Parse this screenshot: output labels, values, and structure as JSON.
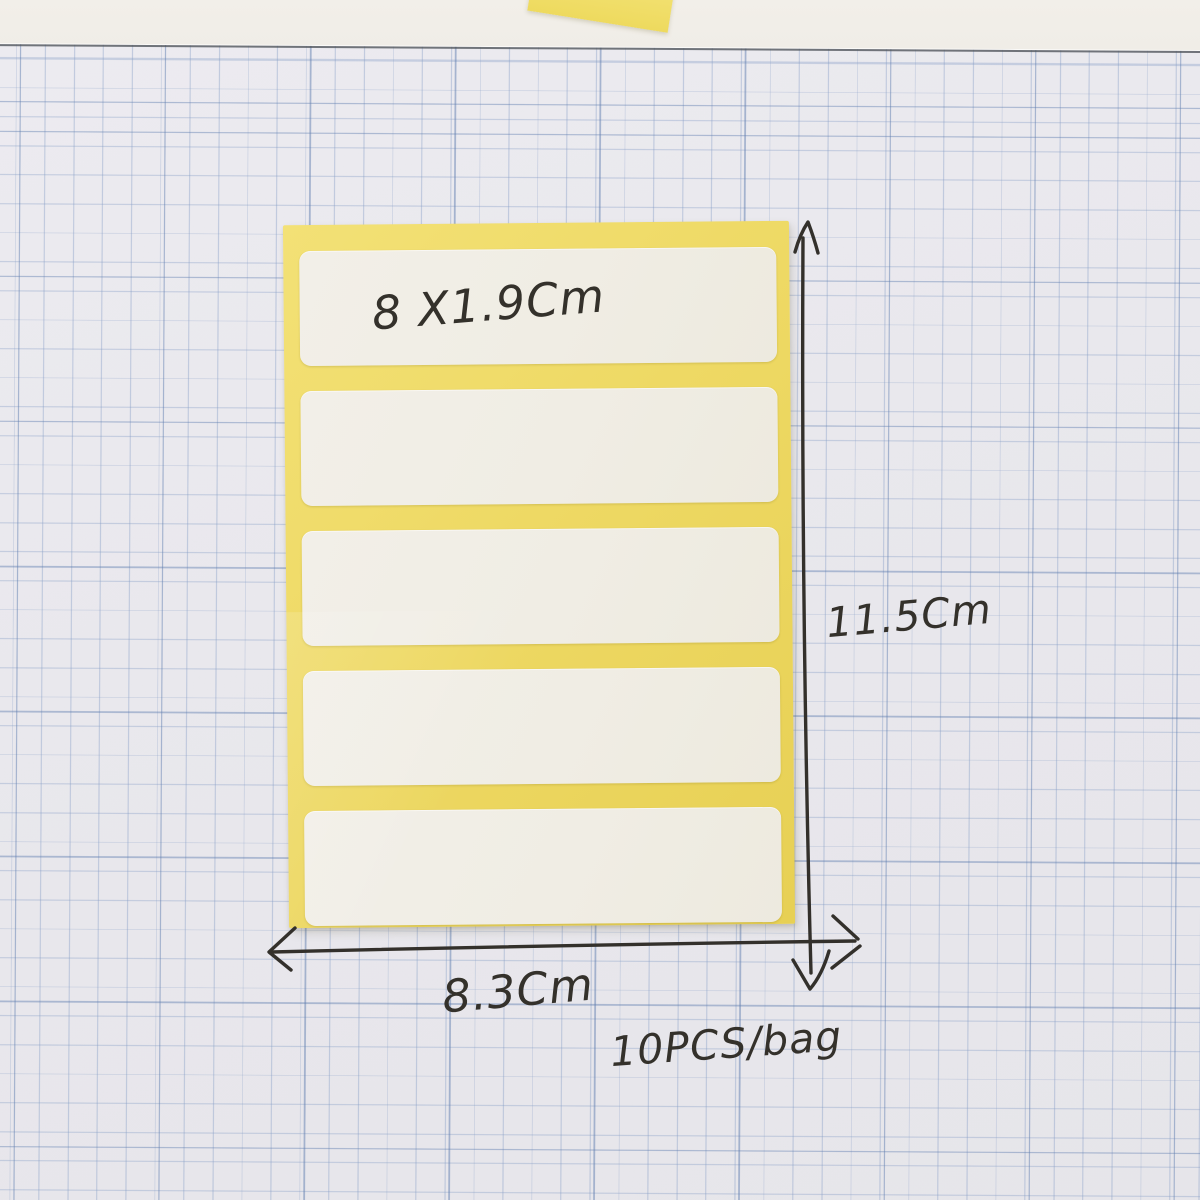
{
  "photo": {
    "subject": "Blank white self-adhesive label stickers on a yellow backing sheet, photographed on blue graph paper",
    "handwritten_annotations": {
      "label_size": "8 X1.9Cm",
      "sheet_height": "11.5Cm",
      "sheet_width": "8.3Cm",
      "pack_quantity": "10PCS/bag"
    },
    "sticker_sheet": {
      "label_count": 5,
      "backing_color_hex": "#eed964",
      "label_color_hex": "#f0ede4"
    },
    "graph_paper": {
      "paper_color_hex": "#e9e8ed",
      "grid_line_color_hex": "#879ec6"
    },
    "ink_color_hex": "#34312b"
  }
}
